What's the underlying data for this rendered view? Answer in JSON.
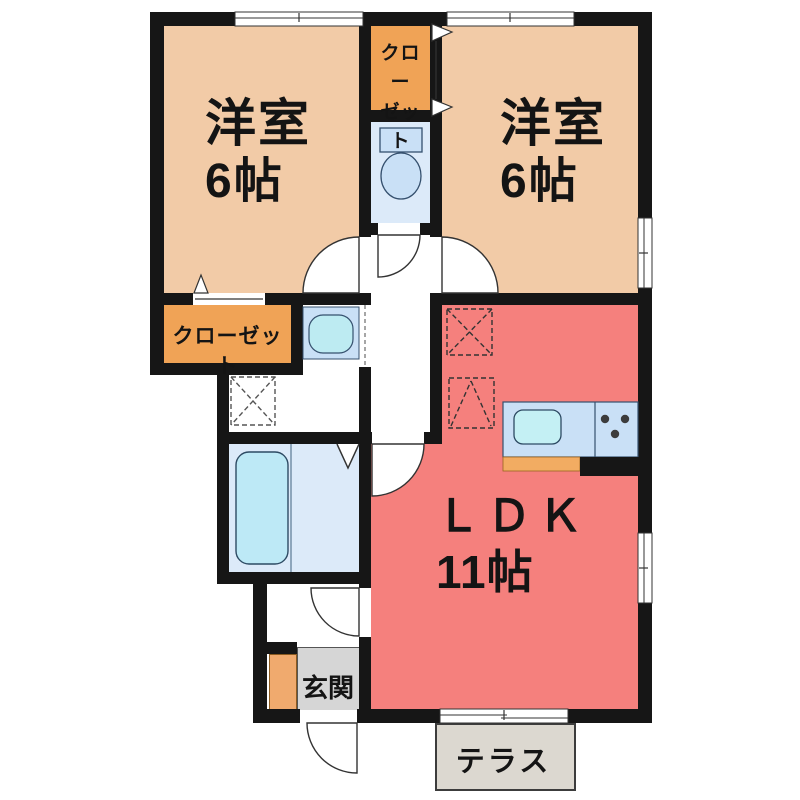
{
  "floorplan": {
    "bedroom_left": {
      "name": "洋室",
      "size": "6帖"
    },
    "bedroom_right": {
      "name": "洋室",
      "size": "6帖"
    },
    "closet_top": {
      "line1": "クロー",
      "line2": "ゼット"
    },
    "closet_side": {
      "name": "クローゼット"
    },
    "ldk": {
      "name": "ＬＤＫ",
      "size": "11帖"
    },
    "entrance": {
      "name": "玄関"
    },
    "terrace": {
      "name": "テラス"
    },
    "icons": {
      "toilet": "toilet-icon",
      "bathtub": "bathtub-icon",
      "washbasin": "washbasin-icon",
      "kitchen_sink": "kitchen-sink-icon",
      "stove_burners": "stove-burners-icon",
      "refrigerator_space": "refrigerator-space-dashed-box",
      "washer_space": "washer-space-dashed-box"
    },
    "colors": {
      "bedroom": "#F2CBA7",
      "closet": "#F0A356",
      "ldk": "#F5807D",
      "wet_area": "#DCEAF9",
      "fixture": "#C9E0F6",
      "bathtub": "#BDE9F6",
      "genkan": "#D6D6D6",
      "terrace": "#DCD8D0",
      "shoe_cabinet": "#F0AA6E",
      "kitchen_trim": "#F2AC62",
      "wall": "#161616"
    }
  }
}
